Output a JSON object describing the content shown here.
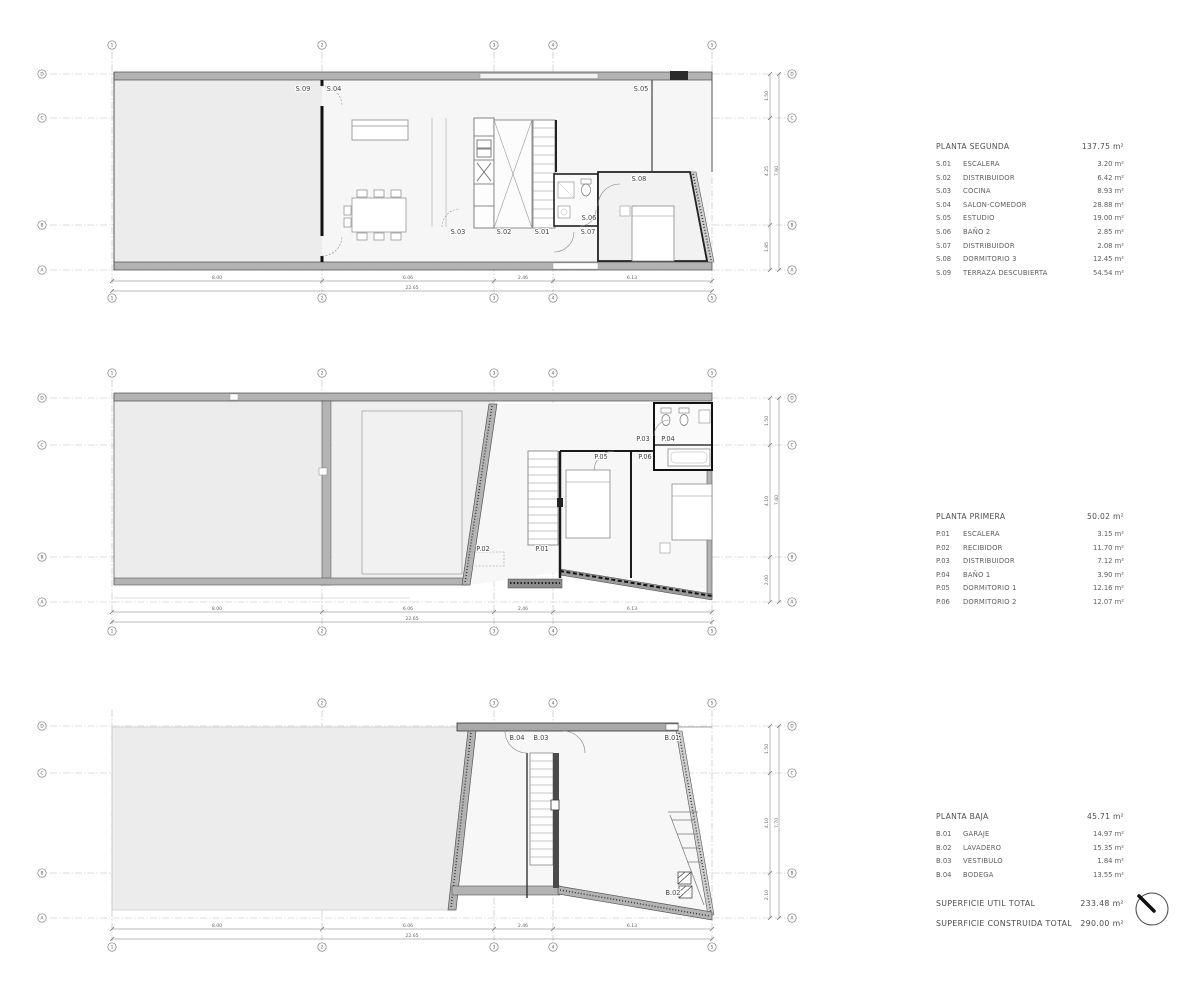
{
  "document": {
    "background": "#ffffff"
  },
  "colors": {
    "wall_gray": "#b3b3b3",
    "wall_dark": "#1a1a1a",
    "floor_fill": "#f6f6f6",
    "terrace_fill": "#ececec",
    "line": "#555555",
    "grid_line": "#b5b5b5",
    "text": "#4a4a4a"
  },
  "plans": [
    {
      "name": "planta-segunda",
      "room_labels": [
        {
          "text": "S.09",
          "x": 303,
          "y": 91
        },
        {
          "text": "S.04",
          "x": 334,
          "y": 91
        },
        {
          "text": "S.05",
          "x": 641,
          "y": 91
        },
        {
          "text": "S.03",
          "x": 458,
          "y": 234
        },
        {
          "text": "S.02",
          "x": 504,
          "y": 234
        },
        {
          "text": "S.01",
          "x": 542,
          "y": 234
        },
        {
          "text": "S.06",
          "x": 589,
          "y": 220
        },
        {
          "text": "S.07",
          "x": 588,
          "y": 234
        },
        {
          "text": "S.08",
          "x": 639,
          "y": 181
        }
      ],
      "grid_bubbles": [
        {
          "label": "1",
          "x": 112,
          "y": 45
        },
        {
          "label": "2",
          "x": 322,
          "y": 45
        },
        {
          "label": "3",
          "x": 494,
          "y": 45
        },
        {
          "label": "4",
          "x": 553,
          "y": 45
        },
        {
          "label": "5",
          "x": 712,
          "y": 45
        },
        {
          "label": "1",
          "x": 112,
          "y": 298
        },
        {
          "label": "2",
          "x": 322,
          "y": 298
        },
        {
          "label": "3",
          "x": 494,
          "y": 298
        },
        {
          "label": "4",
          "x": 553,
          "y": 298
        },
        {
          "label": "5",
          "x": 712,
          "y": 298
        },
        {
          "label": "D",
          "x": 42,
          "y": 74
        },
        {
          "label": "C",
          "x": 42,
          "y": 118
        },
        {
          "label": "B",
          "x": 42,
          "y": 225
        },
        {
          "label": "A",
          "x": 42,
          "y": 270
        },
        {
          "label": "D",
          "x": 792,
          "y": 74
        },
        {
          "label": "C",
          "x": 792,
          "y": 118
        },
        {
          "label": "B",
          "x": 792,
          "y": 225
        },
        {
          "label": "A",
          "x": 792,
          "y": 270
        }
      ],
      "dim_labels": [
        {
          "text": "8.00",
          "x": 217,
          "y": 279
        },
        {
          "text": "6.06",
          "x": 408,
          "y": 279
        },
        {
          "text": "2.46",
          "x": 523,
          "y": 279
        },
        {
          "text": "6.13",
          "x": 632,
          "y": 279
        },
        {
          "text": "22.65",
          "x": 412,
          "y": 289
        },
        {
          "text": "1.50",
          "x": 768,
          "y": 96,
          "rot": -90
        },
        {
          "text": "4.25",
          "x": 768,
          "y": 171,
          "rot": -90
        },
        {
          "text": "1.85",
          "x": 768,
          "y": 247,
          "rot": -90
        },
        {
          "text": "7.60",
          "x": 778,
          "y": 171,
          "rot": -90
        }
      ]
    },
    {
      "name": "planta-primera",
      "room_labels": [
        {
          "text": "P.03",
          "x": 643,
          "y": 441
        },
        {
          "text": "P.04",
          "x": 668,
          "y": 441
        },
        {
          "text": "P.05",
          "x": 601,
          "y": 459
        },
        {
          "text": "P.06",
          "x": 645,
          "y": 459
        },
        {
          "text": "P.02",
          "x": 483,
          "y": 551
        },
        {
          "text": "P.01",
          "x": 542,
          "y": 551
        }
      ],
      "grid_bubbles": [
        {
          "label": "1",
          "x": 112,
          "y": 373
        },
        {
          "label": "2",
          "x": 322,
          "y": 373
        },
        {
          "label": "3",
          "x": 494,
          "y": 373
        },
        {
          "label": "4",
          "x": 553,
          "y": 373
        },
        {
          "label": "5",
          "x": 712,
          "y": 373
        },
        {
          "label": "1",
          "x": 112,
          "y": 631
        },
        {
          "label": "2",
          "x": 322,
          "y": 631
        },
        {
          "label": "3",
          "x": 494,
          "y": 631
        },
        {
          "label": "4",
          "x": 553,
          "y": 631
        },
        {
          "label": "5",
          "x": 712,
          "y": 631
        },
        {
          "label": "D",
          "x": 42,
          "y": 398
        },
        {
          "label": "C",
          "x": 42,
          "y": 445
        },
        {
          "label": "B",
          "x": 42,
          "y": 557
        },
        {
          "label": "A",
          "x": 42,
          "y": 602
        },
        {
          "label": "D",
          "x": 792,
          "y": 398
        },
        {
          "label": "C",
          "x": 792,
          "y": 445
        },
        {
          "label": "B",
          "x": 792,
          "y": 557
        },
        {
          "label": "A",
          "x": 792,
          "y": 602
        }
      ],
      "dim_labels": [
        {
          "text": "8.00",
          "x": 217,
          "y": 610
        },
        {
          "text": "6.06",
          "x": 408,
          "y": 610
        },
        {
          "text": "2.46",
          "x": 523,
          "y": 610
        },
        {
          "text": "6.13",
          "x": 632,
          "y": 610
        },
        {
          "text": "22.65",
          "x": 412,
          "y": 620
        },
        {
          "text": "1.50",
          "x": 768,
          "y": 421,
          "rot": -90
        },
        {
          "text": "4.10",
          "x": 768,
          "y": 501,
          "rot": -90
        },
        {
          "text": "2.00",
          "x": 768,
          "y": 580,
          "rot": -90
        },
        {
          "text": "7.60",
          "x": 778,
          "y": 500,
          "rot": -90
        }
      ]
    },
    {
      "name": "planta-baja",
      "room_labels": [
        {
          "text": "B.04",
          "x": 517,
          "y": 740
        },
        {
          "text": "B.03",
          "x": 541,
          "y": 740
        },
        {
          "text": "B.01",
          "x": 672,
          "y": 740
        },
        {
          "text": "B.02",
          "x": 673,
          "y": 895
        }
      ],
      "grid_bubbles": [
        {
          "label": "2",
          "x": 322,
          "y": 703
        },
        {
          "label": "3",
          "x": 494,
          "y": 703
        },
        {
          "label": "4",
          "x": 553,
          "y": 703
        },
        {
          "label": "5",
          "x": 712,
          "y": 703
        },
        {
          "label": "1",
          "x": 112,
          "y": 947
        },
        {
          "label": "2",
          "x": 322,
          "y": 947
        },
        {
          "label": "3",
          "x": 494,
          "y": 947
        },
        {
          "label": "4",
          "x": 553,
          "y": 947
        },
        {
          "label": "5",
          "x": 712,
          "y": 947
        },
        {
          "label": "D",
          "x": 42,
          "y": 726
        },
        {
          "label": "C",
          "x": 42,
          "y": 773
        },
        {
          "label": "B",
          "x": 42,
          "y": 873
        },
        {
          "label": "A",
          "x": 42,
          "y": 918
        },
        {
          "label": "D",
          "x": 792,
          "y": 726
        },
        {
          "label": "C",
          "x": 792,
          "y": 773
        },
        {
          "label": "B",
          "x": 792,
          "y": 873
        },
        {
          "label": "A",
          "x": 792,
          "y": 918
        }
      ],
      "dim_labels": [
        {
          "text": "8.00",
          "x": 217,
          "y": 927
        },
        {
          "text": "6.06",
          "x": 408,
          "y": 927
        },
        {
          "text": "2.46",
          "x": 523,
          "y": 927
        },
        {
          "text": "6.13",
          "x": 632,
          "y": 927
        },
        {
          "text": "22.65",
          "x": 412,
          "y": 937
        },
        {
          "text": "1.50",
          "x": 768,
          "y": 749,
          "rot": -90
        },
        {
          "text": "4.10",
          "x": 768,
          "y": 823,
          "rot": -90
        },
        {
          "text": "2.10",
          "x": 768,
          "y": 895,
          "rot": -90
        },
        {
          "text": "7.70",
          "x": 778,
          "y": 823,
          "rot": -90
        }
      ]
    }
  ],
  "legends": [
    {
      "title": "PLANTA SEGUNDA",
      "area": "137.75 m²",
      "rows": [
        {
          "code": "S.01",
          "name": "ESCALERA",
          "area": "3.20 m²"
        },
        {
          "code": "S.02",
          "name": "DISTRIBUIDOR",
          "area": "6.42 m²"
        },
        {
          "code": "S.03",
          "name": "COCINA",
          "area": "8.93 m²"
        },
        {
          "code": "S.04",
          "name": "SALON-COMEDOR",
          "area": "28.88 m²"
        },
        {
          "code": "S.05",
          "name": "ESTUDIO",
          "area": "19.00 m²"
        },
        {
          "code": "S.06",
          "name": "BAÑO 2",
          "area": "2.85 m²"
        },
        {
          "code": "S.07",
          "name": "DISTRIBUIDOR",
          "area": "2.08 m²"
        },
        {
          "code": "S.08",
          "name": "DORMITORIO 3",
          "area": "12.45 m²"
        },
        {
          "code": "S.09",
          "name": "TERRAZA DESCUBIERTA",
          "area": "54.54 m²"
        }
      ]
    },
    {
      "title": "PLANTA PRIMERA",
      "area": "50.02 m²",
      "rows": [
        {
          "code": "P.01",
          "name": "ESCALERA",
          "area": "3.15 m²"
        },
        {
          "code": "P.02",
          "name": "RECIBIDOR",
          "area": "11.70 m²"
        },
        {
          "code": "P.03",
          "name": "DISTRIBUIDOR",
          "area": "7.12 m²"
        },
        {
          "code": "P.04",
          "name": "BAÑO 1",
          "area": "3.90 m²"
        },
        {
          "code": "P.05",
          "name": "DORMITORIO 1",
          "area": "12.16 m²"
        },
        {
          "code": "P.06",
          "name": "DORMITORIO 2",
          "area": "12.07 m²"
        }
      ]
    },
    {
      "title": "PLANTA BAJA",
      "area": "45.71 m²",
      "rows": [
        {
          "code": "B.01",
          "name": "GARAJE",
          "area": "14.97 m²"
        },
        {
          "code": "B.02",
          "name": "LAVADERO",
          "area": "15.35 m²"
        },
        {
          "code": "B.03",
          "name": "VESTIBULO",
          "area": "1.84 m²"
        },
        {
          "code": "B.04",
          "name": "BODEGA",
          "area": "13.55 m²"
        }
      ]
    }
  ],
  "totals": [
    {
      "label": "SUPERFICIE UTIL TOTAL",
      "value": "233.48 m²"
    },
    {
      "label": "SUPERFICIE CONSTRUIDA TOTAL",
      "value": "290.00 m²"
    }
  ],
  "north_arrow": "north-arrow"
}
